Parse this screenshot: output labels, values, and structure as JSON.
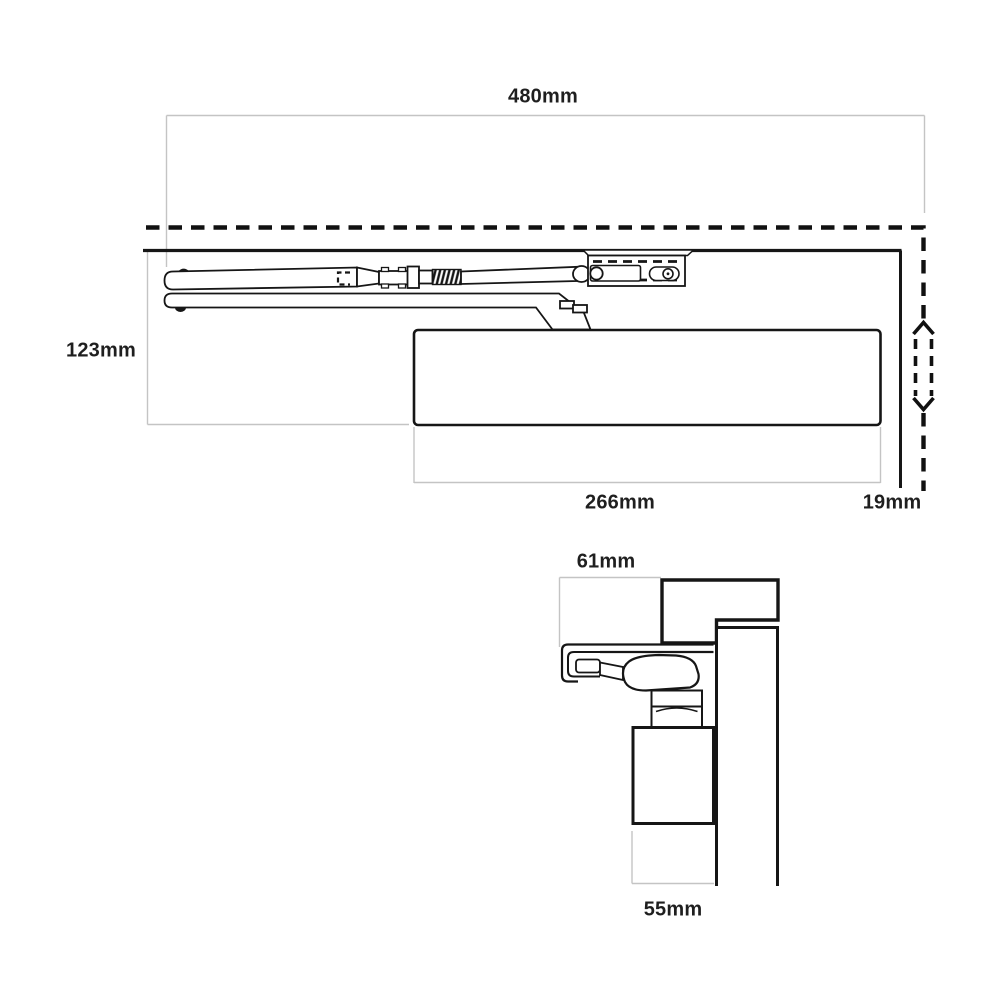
{
  "colors": {
    "background": "#ffffff",
    "drawing_line": "#161616",
    "dimension_line": "#c4c4c4",
    "label_text": "#1f1f1f"
  },
  "front_view": {
    "labels": {
      "overall_width": "480mm",
      "height_below_frame": "123mm",
      "body_length": "266mm",
      "edge_offset": "19mm"
    }
  },
  "side_view": {
    "labels": {
      "track_depth": "61mm",
      "body_depth": "55mm"
    }
  }
}
